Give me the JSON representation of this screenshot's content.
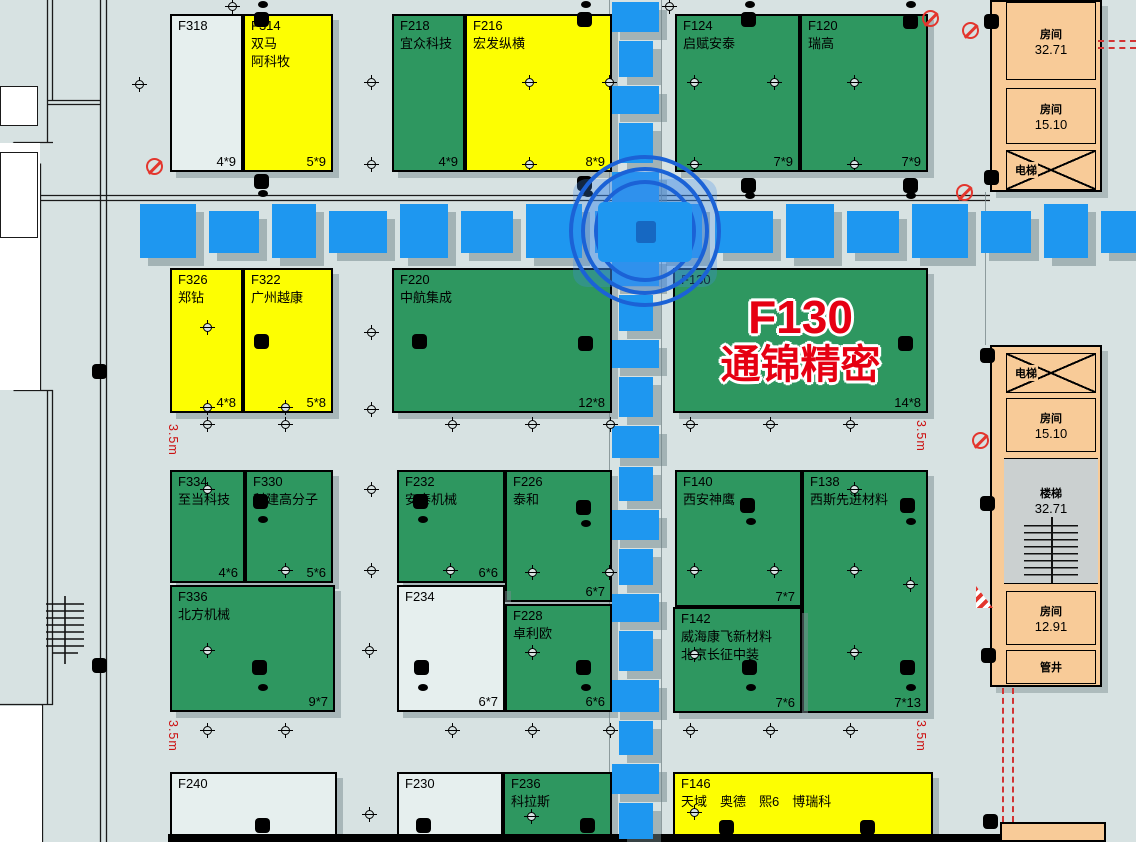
{
  "map": {
    "name": "exhibition-floorplan",
    "colors": {
      "booth_occupied": "#2e9760",
      "booth_reserved": "#fdfe02",
      "booth_empty": "#e6efee",
      "aisle": "#1e97f0",
      "service_room": "#f8cb98",
      "highlight_red": "#e60012"
    }
  },
  "highlight": {
    "booth_id": "F130",
    "lines": [
      "F130",
      "通锦精密"
    ],
    "color": "#e60012"
  },
  "booths": [
    {
      "id": "F318",
      "lines": [],
      "dim": "4*9",
      "fill": "white",
      "x": 170,
      "y": 14,
      "w": 73,
      "h": 158
    },
    {
      "id": "F314",
      "lines": [
        "双马",
        "阿科牧"
      ],
      "dim": "5*9",
      "fill": "yellow",
      "x": 243,
      "y": 14,
      "w": 90,
      "h": 158
    },
    {
      "id": "F218",
      "lines": [
        "宜众科技"
      ],
      "dim": "4*9",
      "fill": "green",
      "x": 392,
      "y": 14,
      "w": 73,
      "h": 158
    },
    {
      "id": "F216",
      "lines": [
        "宏发纵横"
      ],
      "dim": "8*9",
      "fill": "yellow",
      "x": 465,
      "y": 14,
      "w": 147,
      "h": 158
    },
    {
      "id": "F124",
      "lines": [
        "启赋安泰"
      ],
      "dim": "7*9",
      "fill": "green",
      "x": 675,
      "y": 14,
      "w": 125,
      "h": 158
    },
    {
      "id": "F120",
      "lines": [
        "瑞高"
      ],
      "dim": "7*9",
      "fill": "green",
      "x": 800,
      "y": 14,
      "w": 128,
      "h": 158
    },
    {
      "id": "F326",
      "lines": [
        "郑钻"
      ],
      "dim": "4*8",
      "fill": "yellow",
      "x": 170,
      "y": 268,
      "w": 73,
      "h": 145
    },
    {
      "id": "F322",
      "lines": [
        "广州越康"
      ],
      "dim": "5*8",
      "fill": "yellow",
      "x": 243,
      "y": 268,
      "w": 90,
      "h": 145
    },
    {
      "id": "F220",
      "lines": [
        "中航集成"
      ],
      "dim": "12*8",
      "fill": "green",
      "x": 392,
      "y": 268,
      "w": 220,
      "h": 145
    },
    {
      "id": "F130",
      "lines": [],
      "dim": "14*8",
      "fill": "green",
      "x": 673,
      "y": 268,
      "w": 255,
      "h": 145,
      "highlight": true
    },
    {
      "id": "F334",
      "lines": [
        "至当科技"
      ],
      "dim": "4*6",
      "fill": "green",
      "x": 170,
      "y": 470,
      "w": 75,
      "h": 113
    },
    {
      "id": "F330",
      "lines": [
        "科建高分子"
      ],
      "dim": "5*6",
      "fill": "green",
      "x": 245,
      "y": 470,
      "w": 88,
      "h": 113
    },
    {
      "id": "F232",
      "lines": [
        "安泰机械"
      ],
      "dim": "6*6",
      "fill": "green",
      "x": 397,
      "y": 470,
      "w": 108,
      "h": 113
    },
    {
      "id": "F226",
      "lines": [
        "泰和"
      ],
      "dim": "6*7",
      "fill": "green",
      "x": 505,
      "y": 470,
      "w": 107,
      "h": 132
    },
    {
      "id": "F140",
      "lines": [
        "西安神鹰"
      ],
      "dim": "7*7",
      "fill": "green",
      "x": 675,
      "y": 470,
      "w": 127,
      "h": 137
    },
    {
      "id": "F138",
      "lines": [
        "西斯先进材料"
      ],
      "dim": "7*13",
      "fill": "green",
      "x": 802,
      "y": 470,
      "w": 126,
      "h": 243
    },
    {
      "id": "F336",
      "lines": [
        "北方机械"
      ],
      "dim": "9*7",
      "fill": "green",
      "x": 170,
      "y": 585,
      "w": 165,
      "h": 127
    },
    {
      "id": "F234",
      "lines": [],
      "dim": "6*7",
      "fill": "white",
      "x": 397,
      "y": 585,
      "w": 108,
      "h": 127
    },
    {
      "id": "F228",
      "lines": [
        "卓利欧"
      ],
      "dim": "6*6",
      "fill": "green",
      "x": 505,
      "y": 604,
      "w": 107,
      "h": 108
    },
    {
      "id": "F142",
      "lines": [
        "威海康飞新材料",
        "北京长征中装"
      ],
      "dim": "7*6",
      "fill": "green",
      "x": 673,
      "y": 607,
      "w": 129,
      "h": 106
    },
    {
      "id": "F240",
      "lines": [],
      "dim": "",
      "fill": "white",
      "x": 170,
      "y": 772,
      "w": 167,
      "h": 70
    },
    {
      "id": "F230",
      "lines": [],
      "dim": "",
      "fill": "white",
      "x": 397,
      "y": 772,
      "w": 106,
      "h": 70
    },
    {
      "id": "F236",
      "lines": [
        "科拉斯"
      ],
      "dim": "",
      "fill": "green",
      "x": 503,
      "y": 772,
      "w": 109,
      "h": 70
    },
    {
      "id": "F146",
      "lines": [
        "天域　奥德　熙6　博瑞科"
      ],
      "dim": "",
      "fill": "yellow",
      "x": 673,
      "y": 772,
      "w": 260,
      "h": 70
    }
  ],
  "buildings": [
    {
      "x": 990,
      "y": 0,
      "w": 112,
      "h": 192
    },
    {
      "x": 990,
      "y": 345,
      "w": 112,
      "h": 342
    }
  ],
  "rooms": [
    {
      "type": "room",
      "name": "房间",
      "area": "32.71",
      "x": 1006,
      "y": 2,
      "w": 90,
      "h": 78
    },
    {
      "type": "room",
      "name": "房间",
      "area": "15.10",
      "x": 1006,
      "y": 88,
      "w": 90,
      "h": 56
    },
    {
      "type": "elev",
      "name": "电梯",
      "area": "",
      "x": 1006,
      "y": 150,
      "w": 90,
      "h": 40
    },
    {
      "type": "elev",
      "name": "电梯",
      "area": "",
      "x": 1006,
      "y": 353,
      "w": 90,
      "h": 40
    },
    {
      "type": "room",
      "name": "房间",
      "area": "15.10",
      "x": 1006,
      "y": 398,
      "w": 90,
      "h": 54
    },
    {
      "type": "stairs",
      "name": "楼梯",
      "area": "32.71",
      "x": 1004,
      "y": 458,
      "w": 94,
      "h": 126
    },
    {
      "type": "room",
      "name": "房间",
      "area": "12.91",
      "x": 1006,
      "y": 591,
      "w": 90,
      "h": 54
    },
    {
      "type": "room",
      "name": "管井",
      "area": "",
      "x": 1006,
      "y": 650,
      "w": 90,
      "h": 34
    }
  ],
  "spacing_labels": [
    {
      "text": "3.5m",
      "x": 166,
      "y": 424
    },
    {
      "text": "3.5m",
      "x": 166,
      "y": 720
    },
    {
      "text": "3.5m",
      "x": 914,
      "y": 420
    },
    {
      "text": "3.5m",
      "x": 914,
      "y": 720
    }
  ]
}
